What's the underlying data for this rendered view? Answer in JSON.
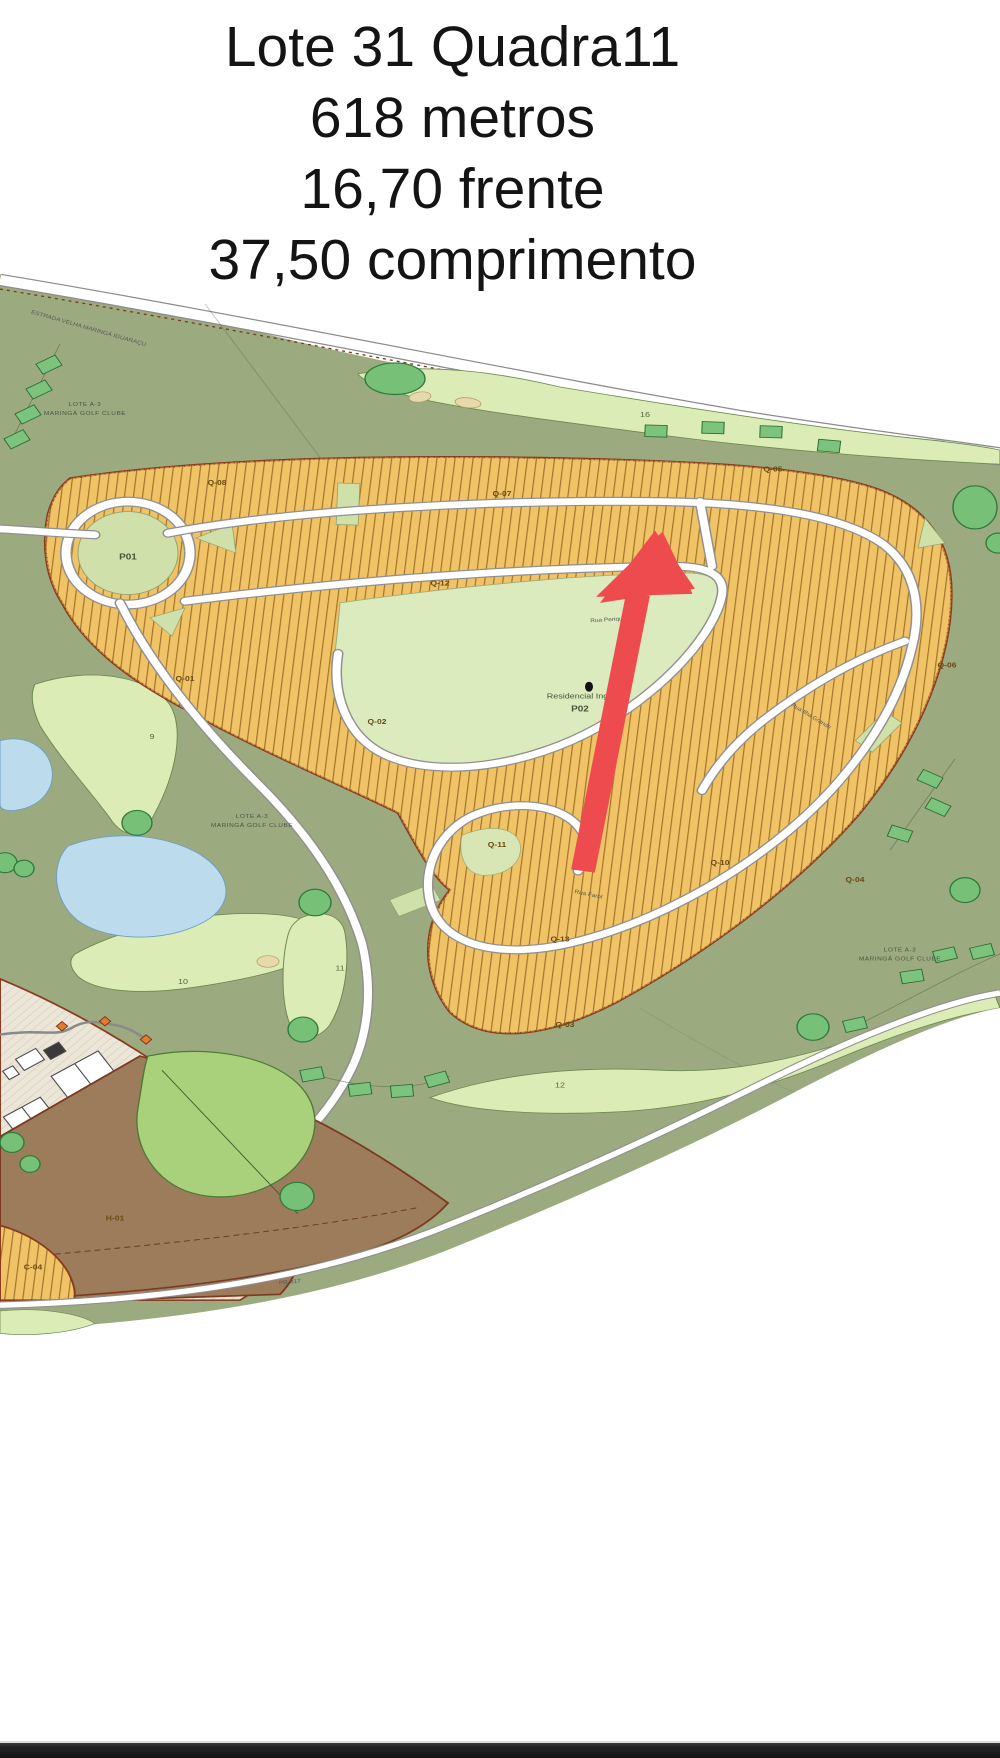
{
  "header": {
    "line1": "Lote 31 Quadra11",
    "line2": "618 metros",
    "line3": "16,70 frente",
    "line4": "37,50 comprimento"
  },
  "map": {
    "estrada_label": "ESTRADA VELHA MARINGÁ IGUARAÇU",
    "golf_club": {
      "l1": "LOTE A-3",
      "l2": "MARINGÁ GOLF CLUBE"
    },
    "parks": {
      "p01": "P01",
      "p02": "P02",
      "residencial": "Residencial Ingá"
    },
    "roads": {
      "periquito": "Rua Periquito",
      "ilha_grande": "Rua Ilha Grande",
      "farol": "Rua Farol",
      "pr317": "PR-317"
    },
    "blocks": {
      "q01": "Q-01",
      "q02": "Q-02",
      "q03": "Q-03",
      "q04": "Q-04",
      "q05": "Q-05",
      "q06": "Q-06",
      "q07": "Q-07",
      "q08": "Q-08",
      "q10": "Q-10",
      "q11": "Q-11",
      "q12": "Q-12",
      "q13": "Q-13",
      "c04": "C-04",
      "h01": "H-01"
    },
    "holes": {
      "h9": "9",
      "h10": "10",
      "h11": "11",
      "h12": "12",
      "h16": "16"
    }
  },
  "colors": {
    "sage": "#9CAA80",
    "fairway": "#DCECB6",
    "lots_orange": "#EFC366",
    "park_green": "#DCEBBD",
    "pond_blue": "#BCDCEE",
    "brown": "#9D7C5C",
    "beige": "#ECE6D9",
    "arrow_red": "#EE4B4E",
    "edge_brown": "#8A3C1E"
  }
}
